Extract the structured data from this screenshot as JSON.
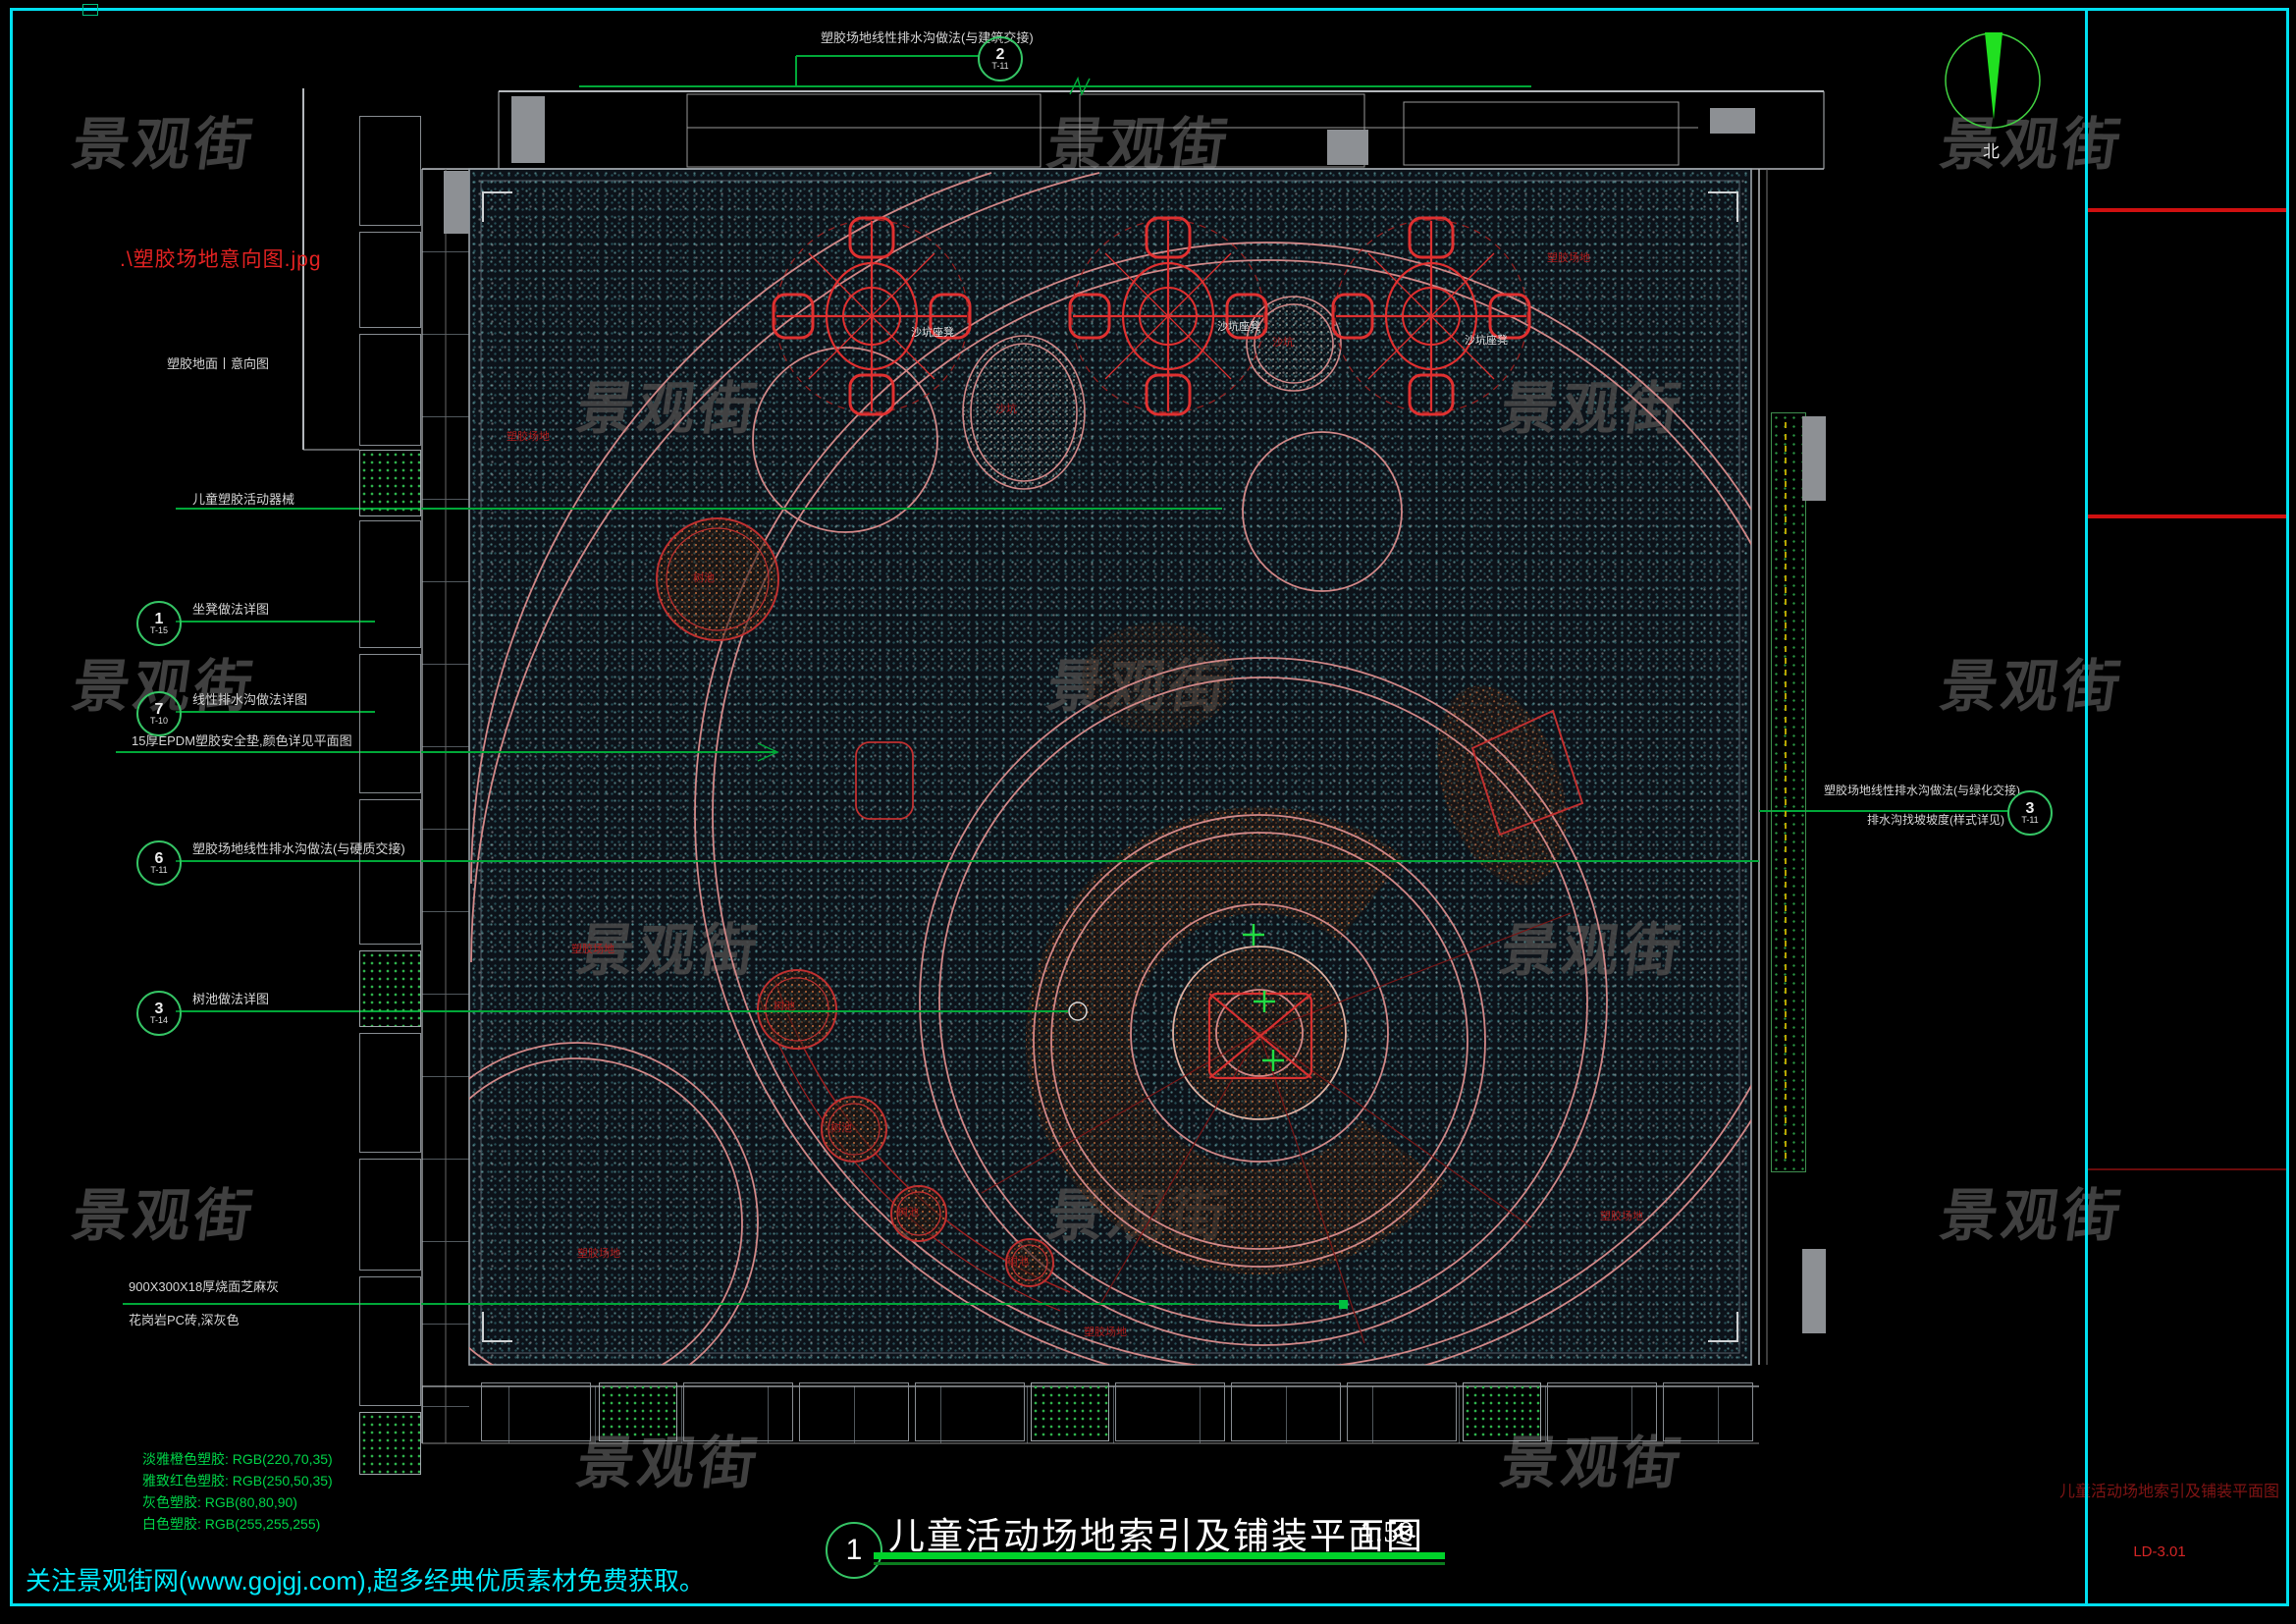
{
  "watermark": {
    "text": "景观街"
  },
  "footer": {
    "text": "关注景观街网(www.gojgj.com),超多经典优质素材免费获取。"
  },
  "north": {
    "label": "北"
  },
  "title_block": {
    "index": "1",
    "title": "儿童活动场地索引及铺装平面图",
    "scale": "1:50"
  },
  "right_panel": {
    "drawing_title": "儿童活动场地索引及铺装平面图",
    "drawing_no": "LD-3.01"
  },
  "left_panel": {
    "image_ref": ".\\塑胶场地意向图.jpg",
    "image_caption": "塑胶地面丨意向图",
    "note_equipment": "儿童塑胶活动器械",
    "note_epdm": "15厚EPDM塑胶安全垫,颜色详见平面图",
    "note_paving_1": "900X300X18厚烧面芝麻灰",
    "note_paving_2": "花岗岩PC砖,深灰色",
    "callouts": [
      {
        "num": "1",
        "code": "T-15",
        "text": "坐凳做法详图"
      },
      {
        "num": "7",
        "code": "T-10",
        "text": "线性排水沟做法详图"
      },
      {
        "num": "6",
        "code": "T-11",
        "text": "塑胶场地线性排水沟做法(与硬质交接)"
      },
      {
        "num": "3",
        "code": "T-14",
        "text": "树池做法详图"
      }
    ],
    "legend": [
      {
        "text": "淡雅橙色塑胶: RGB(220,70,35)"
      },
      {
        "text": "雅致红色塑胶: RGB(250,50,35)"
      },
      {
        "text": "灰色塑胶: RGB(80,80,90)"
      },
      {
        "text": "白色塑胶: RGB(255,255,255)"
      }
    ]
  },
  "top_annotation": {
    "num": "2",
    "code": "T-11",
    "text": "塑胶场地线性排水沟做法(与建筑交接)"
  },
  "right_annotation": {
    "num": "3",
    "code": "T-11",
    "line1": "塑胶场地线性排水沟做法(与绿化交接)",
    "line2": "排水沟找坡坡度(样式详见)"
  },
  "plan": {
    "labels": [
      {
        "text": "沙坑座凳"
      },
      {
        "text": "沙坑座凳"
      },
      {
        "text": "沙坑座凳"
      },
      {
        "text": "沙坑"
      },
      {
        "text": "沙坑"
      },
      {
        "text": "树池"
      },
      {
        "text": "树池"
      },
      {
        "text": "树池"
      },
      {
        "text": "树池"
      },
      {
        "text": "树池"
      },
      {
        "text": "塑胶场地"
      },
      {
        "text": "塑胶场地"
      },
      {
        "text": "塑胶场地"
      },
      {
        "text": "塑胶场地"
      },
      {
        "text": "塑胶场地"
      },
      {
        "text": "塑胶场地"
      }
    ]
  },
  "colors": {
    "frame_cyan": "#00e0f0",
    "cad_green": "#00a838",
    "cad_red": "#d02020",
    "salmon": "#d28888",
    "legend_green": "#00d448"
  }
}
